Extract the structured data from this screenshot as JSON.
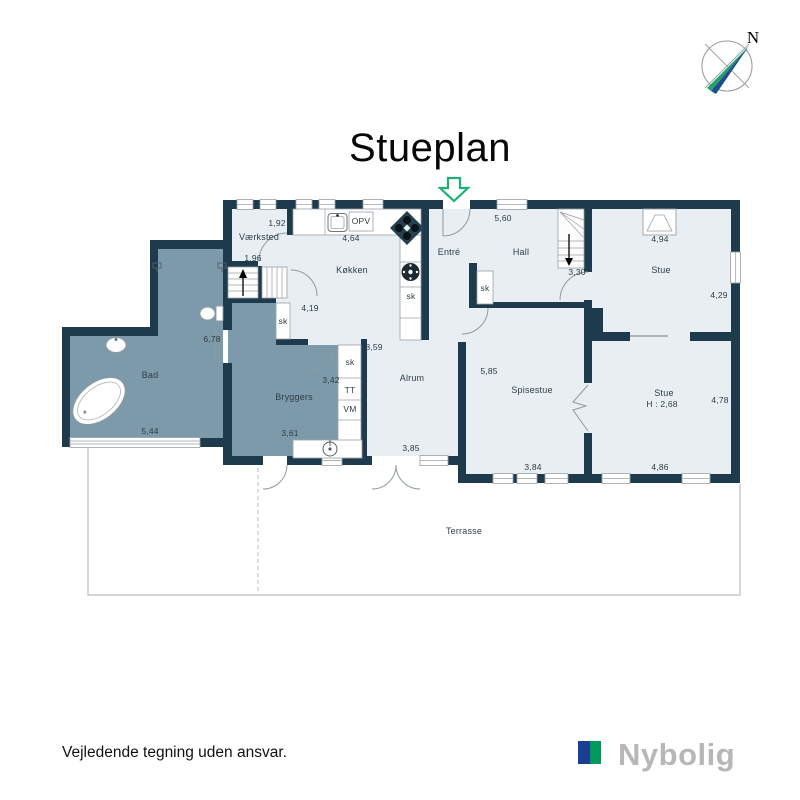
{
  "title": "Stueplan",
  "compass": {
    "north_label": "N"
  },
  "rooms": {
    "vaerksted": "Værksted",
    "koekken": "Køkken",
    "entre": "Entré",
    "hall": "Hall",
    "stue_top": "Stue",
    "bad": "Bad",
    "bryggers": "Bryggers",
    "alrum": "Alrum",
    "spisestue": "Spisestue",
    "stue_bottom": "Stue",
    "stue_bottom_height": "H : 2,68",
    "terrasse": "Terrasse"
  },
  "dimensions": {
    "vaerksted_w": "1,92",
    "vaerksted_h": "1,96",
    "koekken_w": "4,64",
    "koekken_h": "4,19",
    "hall_w": "5,60",
    "stairs_w": "3,30",
    "stue_top_w": "4,94",
    "stue_top_h": "4,29",
    "bad_h": "6,78",
    "bad_w": "5,44",
    "bryggers_w": "3,42",
    "bryggers_w2": "3,61",
    "alrum_h": "8,59",
    "alrum_w": "3,85",
    "spisestue_h": "5,85",
    "spisestue_w": "3,84",
    "stue_bottom_h": "4,78",
    "stue_bottom_w": "4,86"
  },
  "fixtures": {
    "dishwasher": "OPV",
    "closet": "sk",
    "dryer": "TT",
    "washer": "VM"
  },
  "footer": {
    "disclaimer": "Vejledende tegning uden ansvar.",
    "brand": "Nybolig"
  },
  "colors": {
    "wall": "#1e3b4e",
    "room": "#e9eef2",
    "wet_room": "#7d9aab",
    "arrow_green": "#1cb173",
    "logo_blue": "#1c3e92",
    "logo_green": "#00995c",
    "logo_text": "#b5b7b9"
  }
}
